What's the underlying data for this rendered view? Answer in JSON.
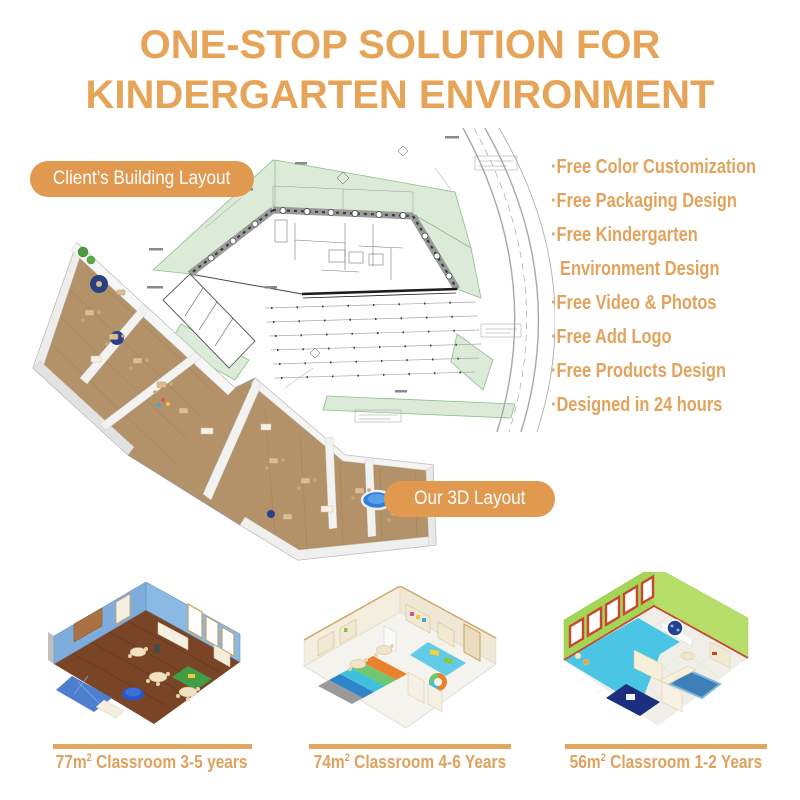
{
  "title": {
    "line1": "ONE-STOP SOLUTION FOR",
    "line2": "KINDERGARTEN ENVIRONMENT"
  },
  "labels": {
    "client_layout": "Client’s Building Layout",
    "our_3d_layout": "Our 3D Layout"
  },
  "features": {
    "items": [
      {
        "text": "·Free Color Customization"
      },
      {
        "text": "·Free Packaging Design"
      },
      {
        "text": "·Free Kindergarten"
      },
      {
        "text": "Environment Design"
      },
      {
        "text": "·Free Video & Photos"
      },
      {
        "text": "·Free Add Logo"
      },
      {
        "text": "·Free Products Design"
      },
      {
        "text": "·Designed in 24 hours"
      }
    ]
  },
  "classrooms": [
    {
      "area": "77m",
      "sup": "2",
      "label": "Classroom 3-5 years"
    },
    {
      "area": "74m",
      "sup": "2",
      "label": "Classroom 4-6 Years"
    },
    {
      "area": "56m",
      "sup": "2",
      "label": "Classroom 1-2 Years"
    }
  ],
  "colors": {
    "accent_text": "#E6A458",
    "badge_bg": "#E0994F",
    "divider_bar": "#E2A661"
  }
}
